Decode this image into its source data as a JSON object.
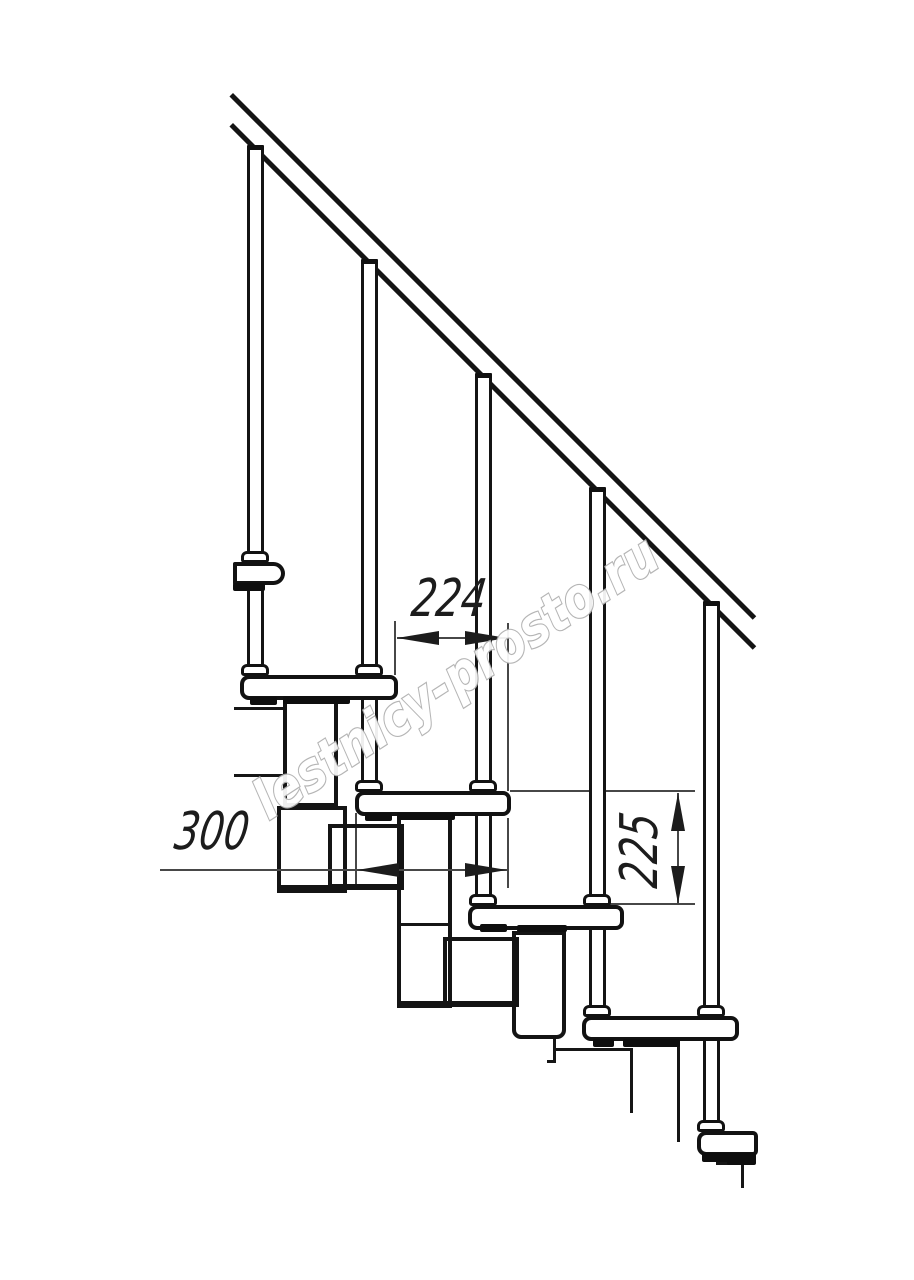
{
  "page": {
    "background": "#ffffff"
  },
  "drawing": {
    "type": "staircase-side-view-fragment",
    "watermark": {
      "text": "lestnicy-prosto.ru",
      "outline_color": "#b0b0b0"
    },
    "dimensions": {
      "tread_run": {
        "value": "224"
      },
      "tread_depth": {
        "value": "300"
      },
      "step_rise": {
        "value": "225"
      }
    },
    "colors": {
      "line": "#141414",
      "dim_line": "#474747",
      "text": "#1c1c1c"
    }
  }
}
